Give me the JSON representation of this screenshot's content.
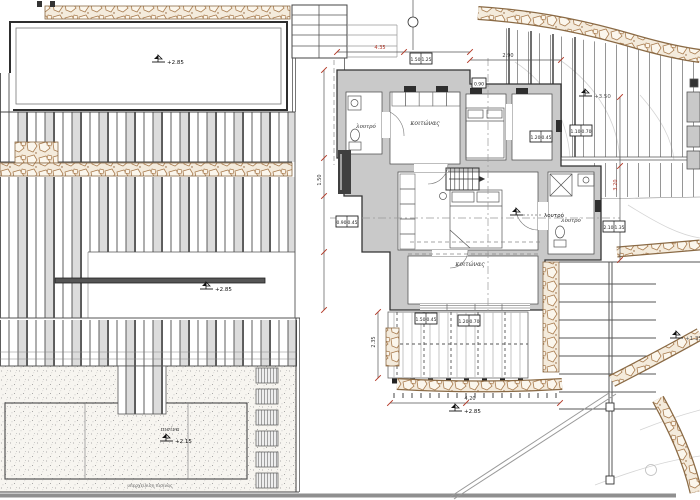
{
  "plan": {
    "rooms": {
      "bedroom_main": "κοιτώνας",
      "bedroom_lower": "κοιτώνας",
      "bath_left": "λουτρό",
      "bath_right": "λουτρό",
      "pool": "πισίνα"
    },
    "levels": {
      "terrace": "+2.85",
      "upper_path": "+3.50",
      "mid_terrace": "+2.85",
      "veranda": "+2.85",
      "pool_level": "+2.15",
      "garden": "+1.35",
      "bath_note": "λουτρό"
    },
    "keynotes": {
      "a": "1.50",
      "b": "1.25",
      "c": "0.90",
      "d": "1.20",
      "e": "0.45",
      "f": "1.10",
      "g": "0.70",
      "h": "2.10",
      "i": "1.35"
    },
    "dims": {
      "d1": "4.35",
      "d2": "2.90",
      "d3": "1.50",
      "d4": "3.20",
      "d5": "4.20",
      "d6": "2.35"
    },
    "captions": {
      "pool_overflow": "υπερχείλιση πισίνας"
    }
  }
}
